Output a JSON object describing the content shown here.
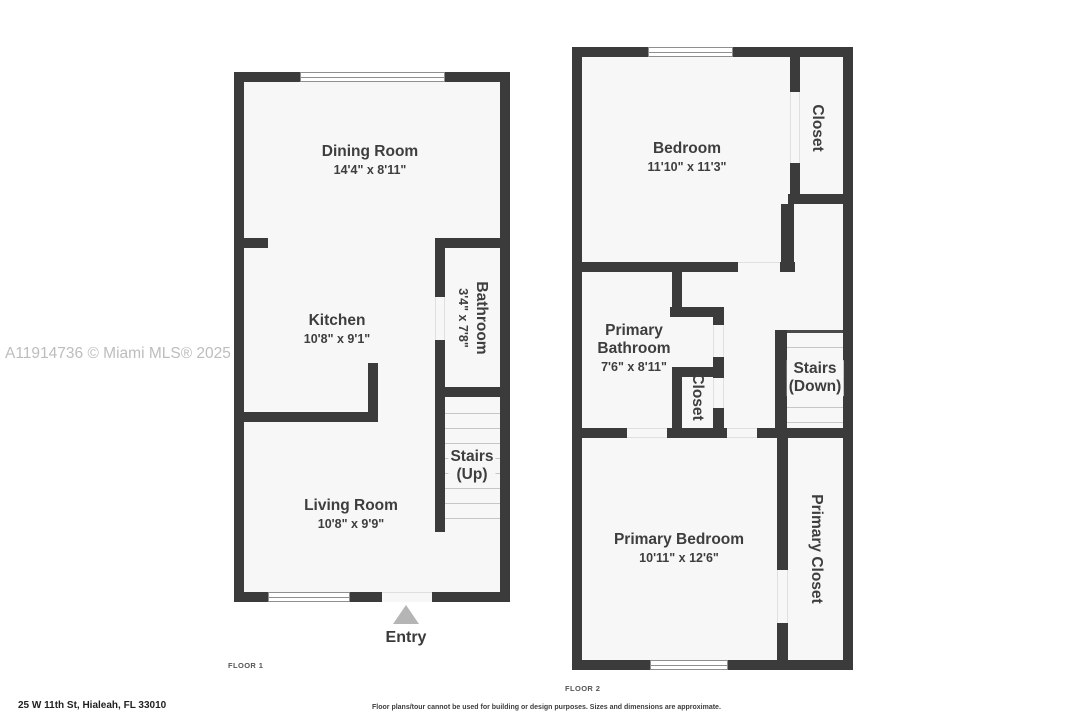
{
  "watermark": "A11914736 © Miami MLS® 2025",
  "floor1": {
    "label": "FLOOR 1",
    "entry": "Entry",
    "rooms": {
      "dining": {
        "name": "Dining Room",
        "dims": "14'4\" x 8'11\""
      },
      "kitchen": {
        "name": "Kitchen",
        "dims": "10'8\" x 9'1\""
      },
      "bathroom": {
        "name": "Bathroom",
        "dims": "3'4\" x 7'8\""
      },
      "stairs": {
        "name": "Stairs",
        "direction": "(Up)"
      },
      "living": {
        "name": "Living Room",
        "dims": "10'8\" x 9'9\""
      }
    }
  },
  "floor2": {
    "label": "FLOOR 2",
    "rooms": {
      "bedroom": {
        "name": "Bedroom",
        "dims": "11'10\" x 11'3\""
      },
      "closet_top": {
        "name": "Closet"
      },
      "primary_bathroom": {
        "name": "Primary Bathroom",
        "dims": "7'6\" x 8'11\""
      },
      "closet_middle": {
        "name": "Closet"
      },
      "stairs": {
        "name": "Stairs",
        "direction": "(Down)"
      },
      "primary_bedroom": {
        "name": "Primary Bedroom",
        "dims": "10'11\" x 12'6\""
      },
      "primary_closet": {
        "name": "Primary Closet"
      }
    }
  },
  "footer": {
    "address": "25 W 11th St, Hialeah, FL 33010",
    "disclaimer": "Floor plans/tour cannot be used for building or design purposes. Sizes and dimensions are approximate."
  },
  "colors": {
    "wall": "#3b3b3b",
    "room_fill": "#f7f7f7",
    "label_text": "#3e3e3e",
    "watermark_text": "#bdbdbd",
    "stair_tread": "#c6c6c6",
    "entry_arrow": "#b5b5b5"
  }
}
